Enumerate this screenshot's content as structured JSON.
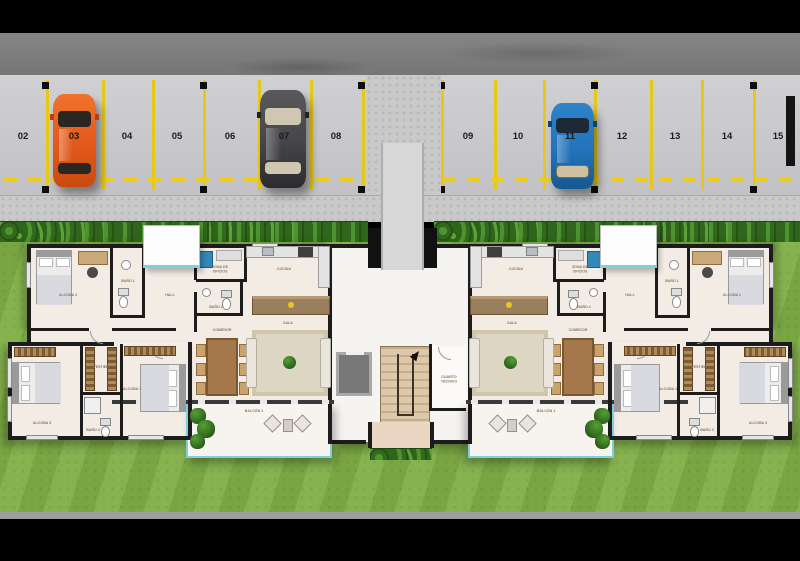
{
  "parking": {
    "spaces": [
      {
        "number": "02",
        "car": null
      },
      {
        "number": "03",
        "car": "orange"
      },
      {
        "number": "04",
        "car": null
      },
      {
        "number": "05",
        "car": null
      },
      {
        "number": "06",
        "car": null
      },
      {
        "number": "07",
        "car": "dark-gray"
      },
      {
        "number": "08",
        "car": null
      },
      {
        "number": "09",
        "car": null
      },
      {
        "number": "10",
        "car": null
      },
      {
        "number": "11",
        "car": "blue"
      },
      {
        "number": "12",
        "car": null
      },
      {
        "number": "13",
        "car": null
      },
      {
        "number": "14",
        "car": null
      },
      {
        "number": "15",
        "car": null
      }
    ],
    "car_colors": {
      "orange": "#e2591b",
      "dark-gray": "#454548",
      "blue": "#2273bb"
    },
    "line_color": "#e9c815"
  },
  "rooms": {
    "alcoba1": "ALCOBA 1",
    "alcoba2": "ALCOBA 2",
    "alcoba3": "ALCOBA 3",
    "bano1": "BAÑO 1",
    "bano2": "BAÑO 2",
    "bano3": "BAÑO 3",
    "vestier": "VESTIER",
    "hall": "HALL",
    "oficios": "ZONA DE OFICIOS",
    "cocina": "COCINA",
    "comedor": "COMEDOR",
    "sala": "SALA",
    "balcon": "BALCÓN 1",
    "cuarto_tecnico": "CUARTO TÉCNICO"
  },
  "colors": {
    "grass": "#7fae46",
    "asphalt": "#cacace",
    "road": "#7c7c7c",
    "floor": "#f3ece4",
    "wall": "#1c1c1c",
    "balcony_glass": "#7ecfe0",
    "hedge": "#2f661c"
  }
}
